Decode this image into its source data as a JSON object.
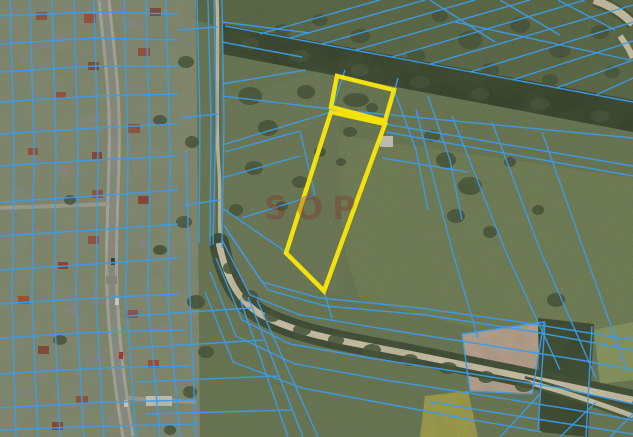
{
  "watermark": {
    "text": "SOP"
  },
  "colors": {
    "cadastral_line": "#3d9be9",
    "highlight_outline": "#f6e50a",
    "field_green": "#6e7b57",
    "forest_green": "#46543a",
    "tree_band": "#39462e",
    "scrub_green": "#5d6b49",
    "road_tan": "#d8cdb2",
    "town_gray": "#8a9077",
    "asphalt": "#92948c",
    "bare_soil_pink": "#c3aa97",
    "crop_yellow": "#a9a54e",
    "watermark_red": "#8b1e1e"
  },
  "highlight": {
    "stroke_width": 4.5,
    "parcels": [
      {
        "id": "north-parcel",
        "points": "337,76 394,90 385,121 331,107"
      },
      {
        "id": "south-parcel",
        "points": "331,112 385,124 324,291 286,253"
      }
    ]
  }
}
